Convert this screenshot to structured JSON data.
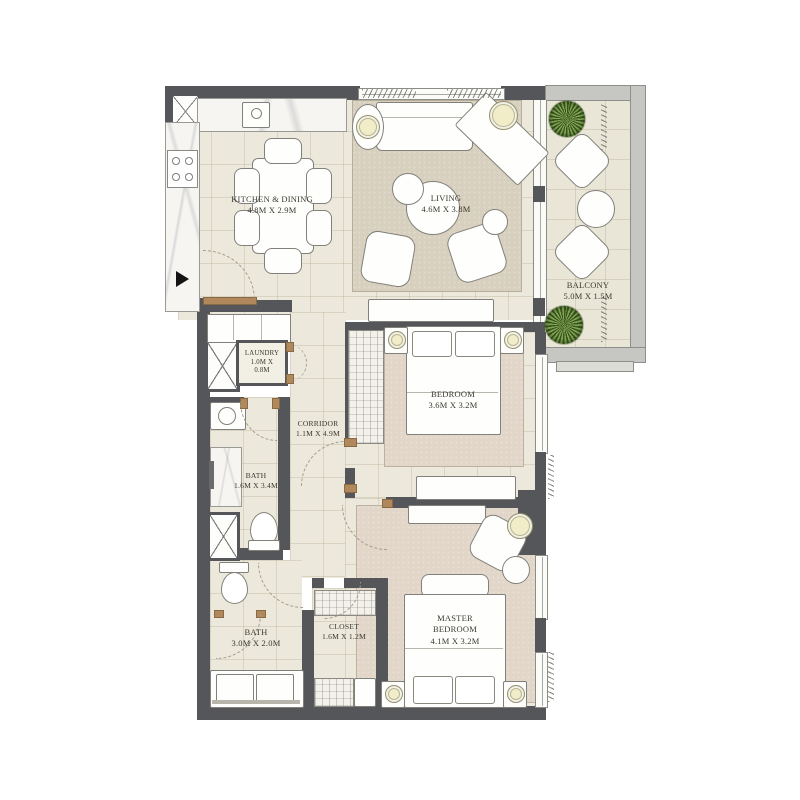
{
  "plan": {
    "rooms": {
      "kitchen": {
        "name": "KITCHEN & DINING",
        "dims": "4.8M X 2.9M"
      },
      "living": {
        "name": "LIVING",
        "dims": "4.6M X 3.8M"
      },
      "balcony": {
        "name": "BALCONY",
        "dims": "5.0M X 1.5M"
      },
      "laundry": {
        "name": "LAUNDRY",
        "dims": "1.0M X 0.8M"
      },
      "corridor": {
        "name": "CORRIDOR",
        "dims": "1.1M X 4.9M"
      },
      "bedroom": {
        "name": "BEDROOM",
        "dims": "3.6M X 3.2M"
      },
      "bath1": {
        "name": "BATH",
        "dims": "1.6M X 3.4M"
      },
      "bath2": {
        "name": "BATH",
        "dims": "3.0M X 2.0M"
      },
      "closet": {
        "name": "CLOSET",
        "dims": "1.6M X 1.2M"
      },
      "master": {
        "name": "MASTER BEDROOM",
        "dims": "4.1M X 3.2M"
      }
    },
    "markers": {
      "entry": "black-right-arrow"
    },
    "colors": {
      "wall": "#54565A",
      "floor_tile": "#ECE8DB",
      "living_rug": "#D7CFBE",
      "bedroom_rug": "#E2D6C9",
      "wood_threshold": "#B0885C",
      "plant_green": "#6F9440",
      "lamp_yellow": "#F1EDC8",
      "balcony_frame": "#C6C7C3"
    }
  }
}
